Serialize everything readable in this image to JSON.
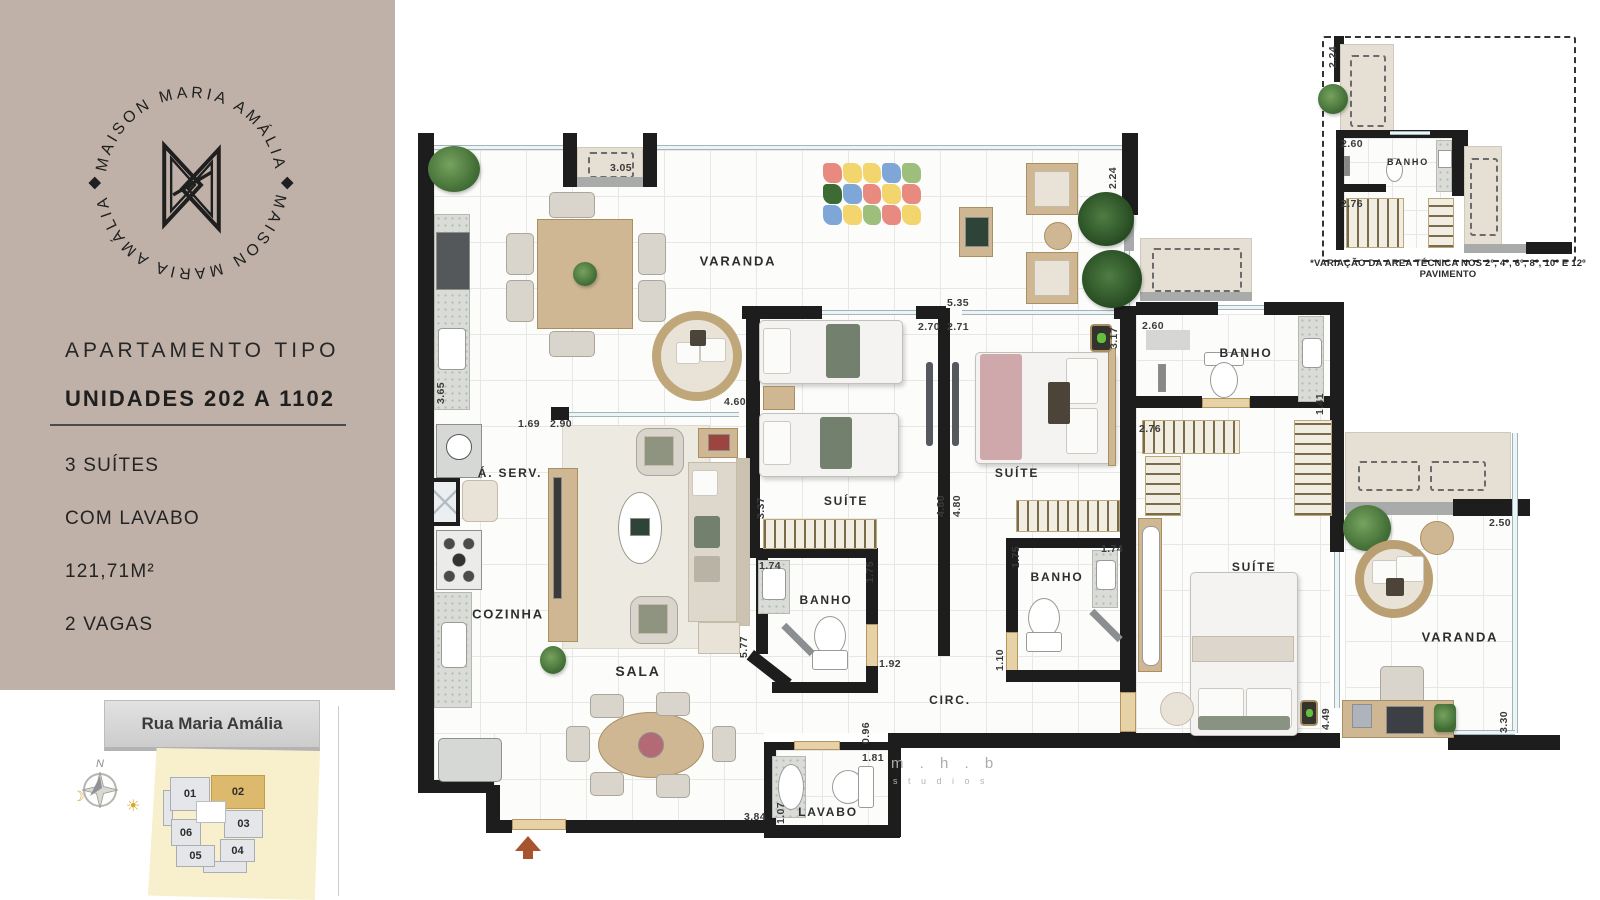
{
  "colors": {
    "sidebar_bg": "#bfb1a8",
    "highlight_unit": "#ddb96d",
    "wall": "#1d1d1d",
    "wood_door": "#e7d2a8",
    "map_cream": "#f8efcd"
  },
  "sidebar": {
    "logo": {
      "arc_top": "MAISON MARIA AMÁLIA",
      "arc_bottom": "MAISON MARIA AMÁLIA"
    },
    "title": "APARTAMENTO TIPO",
    "subtitle": "UNIDADES 202 A 1102",
    "features": [
      "3 SUÍTES",
      "COM LAVABO",
      "121,71M²",
      "2 VAGAS"
    ]
  },
  "key_map": {
    "street_label": "Rua Maria Amália",
    "compass_n": "N",
    "moon_icon": "☽",
    "sun_icon": "☀",
    "units": [
      {
        "id": "01",
        "x": 170,
        "y": 777,
        "w": 40,
        "h": 34,
        "hl": false
      },
      {
        "id": "02",
        "x": 211,
        "y": 775,
        "w": 54,
        "h": 34,
        "hl": true
      },
      {
        "id": "03",
        "x": 224,
        "y": 810,
        "w": 39,
        "h": 28,
        "hl": false
      },
      {
        "id": "04",
        "x": 220,
        "y": 839,
        "w": 35,
        "h": 23,
        "hl": false
      },
      {
        "id": "05",
        "x": 176,
        "y": 845,
        "w": 39,
        "h": 22,
        "hl": false
      },
      {
        "id": "06",
        "x": 171,
        "y": 819,
        "w": 30,
        "h": 27,
        "hl": false
      }
    ]
  },
  "floor_plan": {
    "room_labels": [
      {
        "t": "VARANDA",
        "x": 738,
        "y": 261,
        "s": 13
      },
      {
        "t": "Á. SERV.",
        "x": 510,
        "y": 473,
        "s": 12
      },
      {
        "t": "COZINHA",
        "x": 508,
        "y": 614,
        "s": 13
      },
      {
        "t": "SALA",
        "x": 638,
        "y": 671,
        "s": 14
      },
      {
        "t": "SUÍTE",
        "x": 846,
        "y": 501,
        "s": 12
      },
      {
        "t": "BANHO",
        "x": 826,
        "y": 600,
        "s": 12
      },
      {
        "t": "SUÍTE",
        "x": 1017,
        "y": 473,
        "s": 12
      },
      {
        "t": "BANHO",
        "x": 1057,
        "y": 577,
        "s": 12
      },
      {
        "t": "BANHO",
        "x": 1246,
        "y": 353,
        "s": 12
      },
      {
        "t": "SUÍTE",
        "x": 1254,
        "y": 567,
        "s": 12
      },
      {
        "t": "CIRC.",
        "x": 950,
        "y": 700,
        "s": 12
      },
      {
        "t": "LAVABO",
        "x": 828,
        "y": 812,
        "s": 12
      },
      {
        "t": "VARANDA",
        "x": 1460,
        "y": 637,
        "s": 13
      }
    ],
    "dimension_labels": [
      {
        "t": "3.05",
        "x": 621,
        "y": 168
      },
      {
        "t": "2.24",
        "x": 1113,
        "y": 178,
        "v": true
      },
      {
        "t": "5.35",
        "x": 958,
        "y": 303
      },
      {
        "t": "2.70",
        "x": 929,
        "y": 327
      },
      {
        "t": "2.71",
        "x": 958,
        "y": 327
      },
      {
        "t": "3.17",
        "x": 1114,
        "y": 338,
        "v": true
      },
      {
        "t": "2.60",
        "x": 1153,
        "y": 326
      },
      {
        "t": "4.60",
        "x": 735,
        "y": 402
      },
      {
        "t": "3.65",
        "x": 441,
        "y": 393,
        "v": true
      },
      {
        "t": "1.69",
        "x": 529,
        "y": 424
      },
      {
        "t": "2.90",
        "x": 561,
        "y": 424
      },
      {
        "t": "3.37",
        "x": 761,
        "y": 508,
        "v": true
      },
      {
        "t": "4.80",
        "x": 941,
        "y": 506,
        "v": true
      },
      {
        "t": "4.80",
        "x": 957,
        "y": 506,
        "v": true
      },
      {
        "t": "1.74",
        "x": 770,
        "y": 566
      },
      {
        "t": "1.75",
        "x": 870,
        "y": 572,
        "v": true
      },
      {
        "t": "1.75",
        "x": 1016,
        "y": 557,
        "v": true
      },
      {
        "t": "1.74",
        "x": 1112,
        "y": 549
      },
      {
        "t": "2.76",
        "x": 1150,
        "y": 429
      },
      {
        "t": "1.41",
        "x": 1320,
        "y": 404,
        "v": true
      },
      {
        "t": "5.77",
        "x": 744,
        "y": 647,
        "v": true
      },
      {
        "t": "1.92",
        "x": 890,
        "y": 664
      },
      {
        "t": "1.10",
        "x": 1000,
        "y": 660,
        "v": true
      },
      {
        "t": "0.96",
        "x": 866,
        "y": 733,
        "v": true
      },
      {
        "t": "1.81",
        "x": 873,
        "y": 758
      },
      {
        "t": "1.07",
        "x": 781,
        "y": 813,
        "v": true
      },
      {
        "t": "3.84",
        "x": 755,
        "y": 817
      },
      {
        "t": "2.50",
        "x": 1500,
        "y": 523
      },
      {
        "t": "4.49",
        "x": 1326,
        "y": 719,
        "v": true
      },
      {
        "t": "3.30",
        "x": 1504,
        "y": 722,
        "v": true
      }
    ],
    "play_mat_colors": [
      "#e98a80",
      "#f3d56e",
      "#f3d56e",
      "#7ea7d8",
      "#9cc07c",
      "#3c6b33",
      "#7ea7d8",
      "#e98a80",
      "#f3d56e",
      "#e98a80",
      "#7ea7d8",
      "#f3d56e",
      "#9cc07c",
      "#e98a80",
      "#f3d56e"
    ]
  },
  "inset": {
    "caption": "*VARIAÇÃO DA AREA TÉCNICA NOS 2º, 4º, 6º, 8º, 10º E 12º PAVIMENTO",
    "room_labels": [
      {
        "t": "BANHO",
        "x": 1408,
        "y": 162,
        "s": 9
      }
    ],
    "dimension_labels": [
      {
        "t": "2.24",
        "x": 1333,
        "y": 57,
        "v": true
      },
      {
        "t": "2.60",
        "x": 1352,
        "y": 144
      },
      {
        "t": "2.76",
        "x": 1352,
        "y": 204
      }
    ]
  },
  "watermark": {
    "line1": "m . h . b",
    "line2": "s t u d i o s"
  }
}
